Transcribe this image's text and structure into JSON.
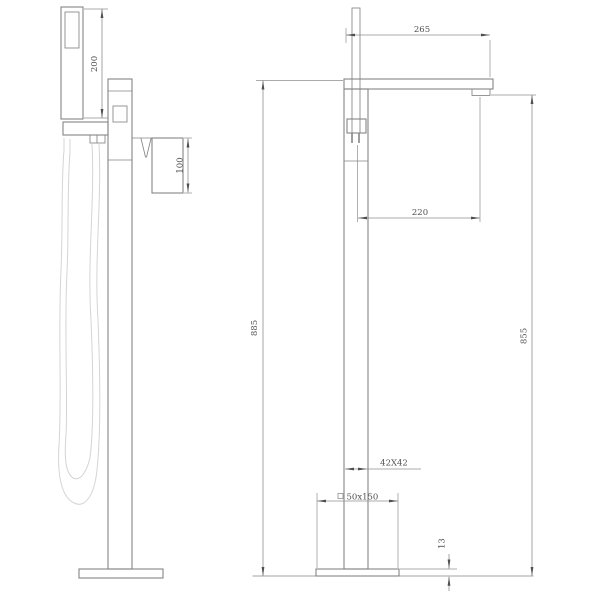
{
  "title": "Freestanding bath shower mixer technical drawing",
  "dimensions": {
    "handshower_length": "200",
    "handle_height": "100",
    "spout_reach": "265",
    "rod_to_outlet": "220",
    "total_height": "885",
    "outlet_height": "855",
    "column_section": "42X42",
    "base_section": "50x150",
    "base_thickness": "13"
  },
  "colors": {
    "line": "#858585",
    "dim": "#8f8f8f",
    "text": "#4f4f4f",
    "hose": "#d4d4d4",
    "background": "#ffffff"
  }
}
